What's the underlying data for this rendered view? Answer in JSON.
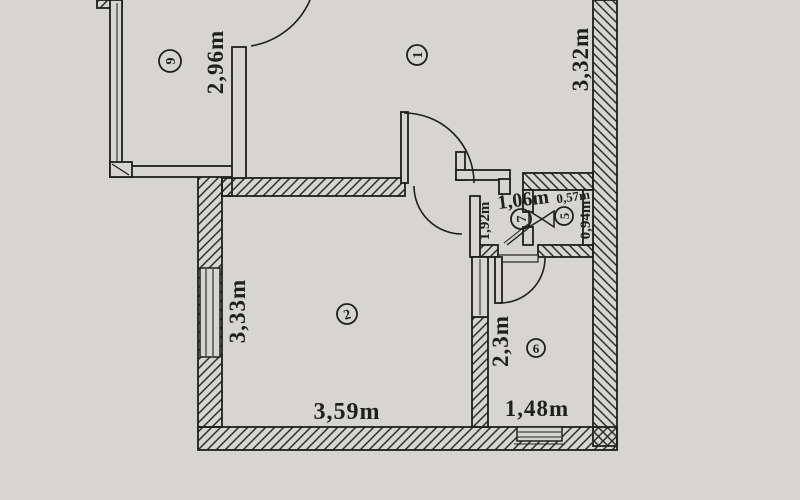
{
  "colors": {
    "paper": "#d6d5d2",
    "ink": "#1f1f1f"
  },
  "labels": {
    "room9_number": "9",
    "room1_number": "1",
    "room2_number": "2",
    "room5_number": "5",
    "room6_number": "6",
    "room7_number": "7",
    "room9_dim": "2,96m",
    "room1_dim": "3,32m",
    "room2_dim_vertical": "3,33m",
    "room2_dim_horizontal": "3,59m",
    "room6_dim_vertical": "2,3m",
    "room6_dim_horizontal": "1,48m",
    "hall_dim_vertical": "1,92m",
    "hall_dim_horizontal": "1,06m",
    "room5_dim_horizontal": "0,57m",
    "room5_dim_vertical": "0,94m"
  }
}
